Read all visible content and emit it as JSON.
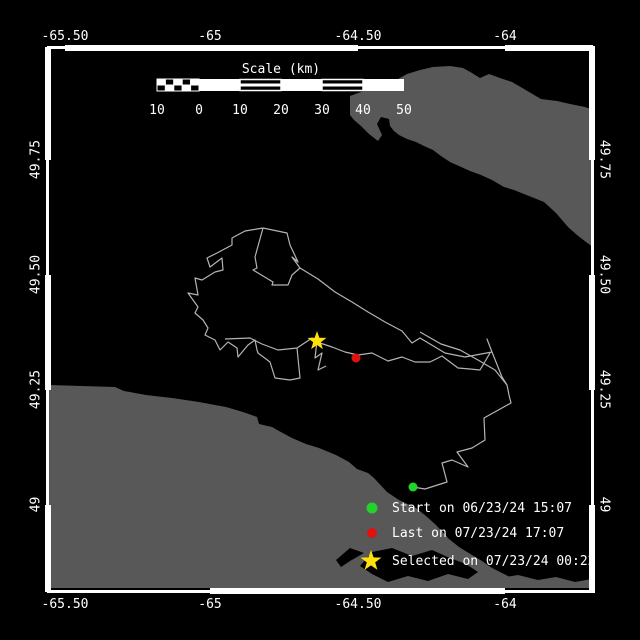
{
  "colors": {
    "background": "#000000",
    "frame": "#ffffff",
    "label_text": "#ffffff",
    "land": "#585858",
    "track": "#b4b4b4",
    "start_marker": "#22d32b",
    "last_marker": "#e01111",
    "selected_marker": "#ffdf0e"
  },
  "scale_bar": {
    "title": "Scale (km)",
    "tick_labels": [
      "10",
      "0",
      "10",
      "20",
      "30",
      "40",
      "50"
    ]
  },
  "axis": {
    "top_labels": [
      "-65.50",
      "-65",
      "-64.50",
      "-64"
    ],
    "bottom_labels": [
      "-65.50",
      "-65",
      "-64.50",
      "-64"
    ],
    "left_labels": [
      "49.75",
      "49.50",
      "49.25",
      "49"
    ],
    "right_labels": [
      "49.75",
      "49.50",
      "49.25",
      "49"
    ]
  },
  "legend": {
    "items": [
      {
        "marker": "circle",
        "color_key": "start_marker",
        "label": "Start on 06/23/24 15:07"
      },
      {
        "marker": "circle",
        "color_key": "last_marker",
        "label": "Last on 07/23/24 17:07"
      },
      {
        "marker": "star",
        "color_key": "selected_marker",
        "label": "Selected on 07/23/24 00:22"
      }
    ]
  },
  "chart_data": {
    "type": "map_track",
    "projection": "mercator",
    "lon_ticks_deg": [
      -65.5,
      -65.0,
      -64.5,
      -64.0
    ],
    "lat_ticks_deg": [
      49.75,
      49.5,
      49.25,
      49.0
    ],
    "scale_km_ticks": [
      -10,
      0,
      10,
      20,
      30,
      40,
      50
    ],
    "events": [
      {
        "name": "Start",
        "datetime": "06/23/24 15:07",
        "marker": "green-circle"
      },
      {
        "name": "Last",
        "datetime": "07/23/24 17:07",
        "marker": "red-circle"
      },
      {
        "name": "Selected",
        "datetime": "07/23/24 00:22",
        "marker": "yellow-star"
      }
    ]
  },
  "render": {
    "frame": {
      "l": 47,
      "t": 47,
      "r": 593,
      "b": 592
    },
    "bars": {
      "top": [
        [
          65,
          358
        ],
        [
          505,
          593
        ]
      ],
      "bottom": [
        [
          210,
          505
        ]
      ],
      "left": [
        [
          47,
          160
        ],
        [
          275,
          390
        ],
        [
          505,
          592
        ]
      ],
      "right": [
        [
          47,
          160
        ],
        [
          275,
          390
        ],
        [
          505,
          592
        ]
      ]
    },
    "scale": {
      "x_ticks": [
        157,
        199,
        240,
        281,
        322,
        363,
        404
      ],
      "y": 79,
      "h": 12
    },
    "land": [
      [
        [
          350,
          96
        ],
        [
          358,
          93
        ],
        [
          368,
          90
        ],
        [
          382,
          86
        ],
        [
          398,
          79
        ],
        [
          407,
          74
        ],
        [
          420,
          70
        ],
        [
          433,
          67
        ],
        [
          450,
          66
        ],
        [
          463,
          68
        ],
        [
          472,
          73
        ],
        [
          480,
          78
        ],
        [
          489,
          74
        ],
        [
          500,
          78
        ],
        [
          512,
          82
        ],
        [
          524,
          89
        ],
        [
          541,
          99
        ],
        [
          557,
          101
        ],
        [
          570,
          104
        ],
        [
          585,
          107
        ],
        [
          593,
          110
        ],
        [
          593,
          247
        ],
        [
          586,
          242
        ],
        [
          577,
          235
        ],
        [
          568,
          227
        ],
        [
          556,
          213
        ],
        [
          544,
          202
        ],
        [
          529,
          196
        ],
        [
          514,
          190
        ],
        [
          504,
          187
        ],
        [
          492,
          180
        ],
        [
          481,
          175
        ],
        [
          470,
          171
        ],
        [
          459,
          166
        ],
        [
          450,
          162
        ],
        [
          441,
          156
        ],
        [
          433,
          150
        ],
        [
          424,
          146
        ],
        [
          416,
          142
        ],
        [
          407,
          139
        ],
        [
          399,
          135
        ],
        [
          394,
          131
        ],
        [
          390,
          126
        ],
        [
          389,
          119
        ],
        [
          381,
          117
        ],
        [
          377,
          124
        ],
        [
          382,
          135
        ],
        [
          378,
          141
        ],
        [
          369,
          134
        ],
        [
          361,
          126
        ],
        [
          354,
          120
        ],
        [
          350,
          115
        ]
      ],
      [
        [
          47,
          385
        ],
        [
          115,
          387
        ],
        [
          124,
          391
        ],
        [
          146,
          395
        ],
        [
          172,
          398
        ],
        [
          199,
          402
        ],
        [
          226,
          407
        ],
        [
          243,
          412
        ],
        [
          257,
          417
        ],
        [
          259,
          424
        ],
        [
          272,
          427
        ],
        [
          279,
          431
        ],
        [
          292,
          438
        ],
        [
          306,
          444
        ],
        [
          319,
          448
        ],
        [
          336,
          455
        ],
        [
          349,
          462
        ],
        [
          357,
          469
        ],
        [
          368,
          473
        ],
        [
          374,
          478
        ],
        [
          387,
          492
        ],
        [
          399,
          500
        ],
        [
          416,
          508
        ],
        [
          426,
          516
        ],
        [
          436,
          525
        ],
        [
          449,
          539
        ],
        [
          459,
          547
        ],
        [
          472,
          555
        ],
        [
          482,
          561
        ],
        [
          492,
          568
        ],
        [
          504,
          574
        ],
        [
          516,
          580
        ],
        [
          529,
          584
        ],
        [
          540,
          588
        ],
        [
          47,
          588
        ]
      ],
      [
        [
          468,
          578
        ],
        [
          480,
          573
        ],
        [
          500,
          578
        ],
        [
          518,
          575
        ],
        [
          538,
          580
        ],
        [
          556,
          577
        ],
        [
          575,
          582
        ],
        [
          592,
          579
        ],
        [
          592,
          588
        ],
        [
          468,
          588
        ]
      ]
    ],
    "water_cutouts": [
      [
        [
          336,
          560
        ],
        [
          350,
          548
        ],
        [
          364,
          553
        ],
        [
          350,
          561
        ],
        [
          341,
          567
        ]
      ],
      [
        [
          372,
          552
        ],
        [
          392,
          548
        ],
        [
          412,
          556
        ],
        [
          432,
          550
        ],
        [
          450,
          558
        ],
        [
          466,
          564
        ],
        [
          478,
          572
        ],
        [
          468,
          579
        ],
        [
          448,
          574
        ],
        [
          428,
          581
        ],
        [
          408,
          576
        ],
        [
          388,
          582
        ],
        [
          372,
          574
        ],
        [
          360,
          566
        ]
      ]
    ],
    "track": [
      [
        [
          263,
          228
        ],
        [
          287,
          233
        ],
        [
          290,
          245
        ],
        [
          298,
          262
        ],
        [
          292,
          257
        ],
        [
          300,
          268
        ],
        [
          318,
          279
        ],
        [
          335,
          292
        ],
        [
          352,
          302
        ],
        [
          368,
          312
        ],
        [
          385,
          322
        ],
        [
          402,
          331
        ],
        [
          412,
          343
        ],
        [
          420,
          338
        ],
        [
          445,
          353
        ],
        [
          465,
          357
        ],
        [
          492,
          352
        ],
        [
          487,
          339
        ],
        [
          492,
          352
        ],
        [
          502,
          377
        ],
        [
          507,
          385
        ]
      ],
      [
        [
          263,
          228
        ],
        [
          255,
          257
        ],
        [
          257,
          268
        ],
        [
          253,
          270
        ],
        [
          273,
          282
        ],
        [
          272,
          285
        ],
        [
          288,
          285
        ],
        [
          292,
          275
        ],
        [
          300,
          268
        ]
      ],
      [
        [
          263,
          228
        ],
        [
          245,
          231
        ],
        [
          232,
          238
        ],
        [
          232,
          245
        ],
        [
          217,
          253
        ],
        [
          207,
          258
        ],
        [
          210,
          267
        ],
        [
          222,
          258
        ],
        [
          223,
          270
        ],
        [
          215,
          272
        ],
        [
          202,
          280
        ],
        [
          195,
          278
        ],
        [
          198,
          295
        ],
        [
          188,
          293
        ],
        [
          198,
          307
        ],
        [
          195,
          313
        ],
        [
          203,
          320
        ],
        [
          208,
          328
        ],
        [
          205,
          335
        ],
        [
          215,
          340
        ],
        [
          220,
          350
        ],
        [
          228,
          342
        ],
        [
          237,
          348
        ],
        [
          238,
          357
        ],
        [
          248,
          345
        ],
        [
          255,
          340
        ],
        [
          257,
          350
        ]
      ],
      [
        [
          225,
          339
        ],
        [
          250,
          338
        ],
        [
          262,
          344
        ],
        [
          278,
          350
        ],
        [
          297,
          348
        ],
        [
          312,
          338
        ],
        [
          320,
          343
        ],
        [
          332,
          347
        ],
        [
          345,
          352
        ],
        [
          358,
          355
        ],
        [
          372,
          353
        ],
        [
          388,
          361
        ],
        [
          402,
          357
        ],
        [
          415,
          362
        ],
        [
          430,
          362
        ],
        [
          442,
          356
        ],
        [
          458,
          368
        ],
        [
          470,
          369
        ],
        [
          480,
          370
        ],
        [
          490,
          353
        ]
      ],
      [
        [
          257,
          350
        ],
        [
          258,
          353
        ],
        [
          270,
          362
        ],
        [
          275,
          378
        ],
        [
          290,
          380
        ],
        [
          300,
          378
        ],
        [
          297,
          348
        ]
      ],
      [
        [
          317,
          341
        ],
        [
          315,
          358
        ],
        [
          322,
          353
        ],
        [
          318,
          370
        ],
        [
          326,
          366
        ]
      ],
      [
        [
          507,
          385
        ],
        [
          509,
          395
        ],
        [
          511,
          403
        ],
        [
          484,
          418
        ],
        [
          485,
          440
        ],
        [
          472,
          448
        ],
        [
          457,
          452
        ],
        [
          468,
          467
        ],
        [
          452,
          460
        ],
        [
          442,
          463
        ],
        [
          447,
          482
        ],
        [
          425,
          489
        ],
        [
          413,
          487
        ]
      ],
      [
        [
          420,
          332
        ],
        [
          441,
          344
        ],
        [
          460,
          350
        ],
        [
          478,
          360
        ],
        [
          495,
          370
        ],
        [
          507,
          385
        ]
      ]
    ],
    "markers": [
      {
        "shape": "circle",
        "x": 413,
        "y": 487,
        "r": 4.5,
        "color_key": "start_marker",
        "name": "start-marker"
      },
      {
        "shape": "circle",
        "x": 356,
        "y": 358,
        "r": 4.5,
        "color_key": "last_marker",
        "name": "last-marker"
      },
      {
        "shape": "star",
        "x": 317,
        "y": 341,
        "r": 10,
        "color_key": "selected_marker",
        "name": "selected-marker"
      },
      {
        "shape": "circle",
        "x": 372,
        "y": 508,
        "r": 5.5,
        "color_key": "start_marker",
        "name": "legend-start-marker"
      },
      {
        "shape": "circle",
        "x": 372,
        "y": 533,
        "r": 5,
        "color_key": "last_marker",
        "name": "legend-last-marker"
      },
      {
        "shape": "star",
        "x": 371,
        "y": 561,
        "r": 11,
        "color_key": "selected_marker",
        "name": "legend-selected-marker"
      }
    ]
  }
}
